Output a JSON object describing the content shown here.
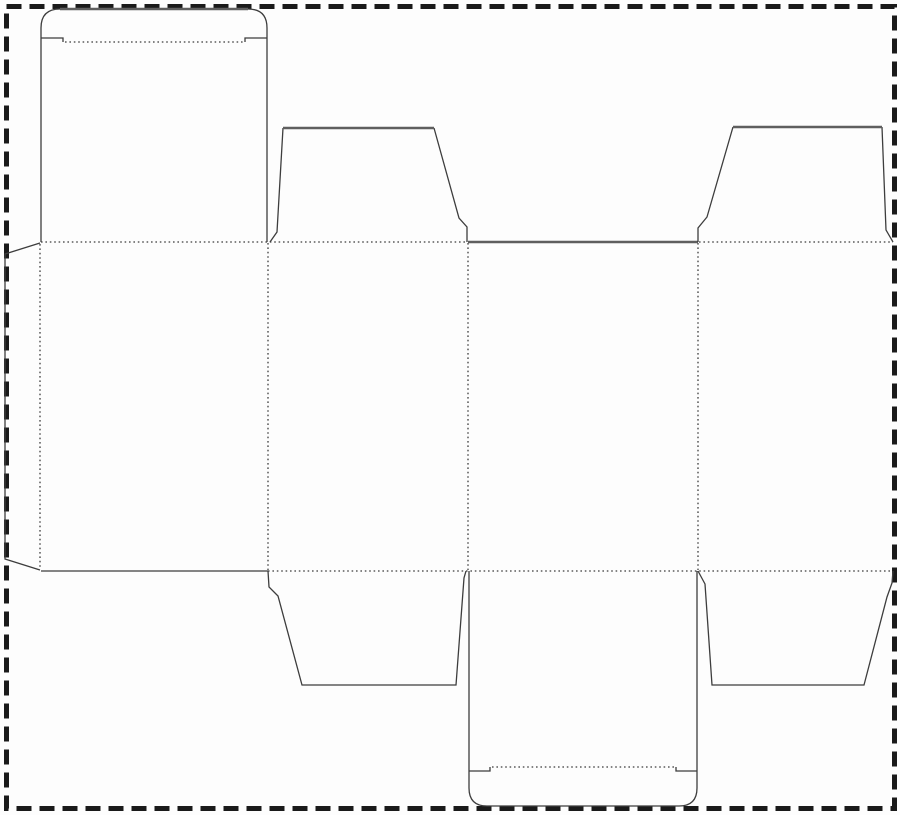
{
  "canvas": {
    "width": 900,
    "height": 815,
    "background": "#fdfdfd"
  },
  "border": {
    "x": 6.5,
    "y": 6.5,
    "width": 888,
    "height": 802,
    "stroke": "#1a1a1a",
    "stroke_width": 5,
    "dash": "15 8"
  },
  "styles": {
    "cut": {
      "stroke": "#3d3d3d",
      "width": 1.3
    },
    "heavy": {
      "stroke": "#5f5f5f",
      "width": 2.4
    },
    "fold": {
      "stroke": "#3d3d3d",
      "width": 1.3,
      "dash": "1.6 2.8"
    }
  },
  "shapes": [
    {
      "name": "top-lid-left-edge",
      "style": "cut",
      "d": "M41,242 L41,28 Q41,9 60,9"
    },
    {
      "name": "top-lid-top-edge",
      "style": "heavy",
      "d": "M60,9 L248,9"
    },
    {
      "name": "top-lid-right-edge",
      "style": "cut",
      "d": "M248,9 Q267,9 267,28 L267,242"
    },
    {
      "name": "top-lid-tuck-notch-left",
      "style": "cut",
      "d": "M41,38 L63,38 L63,42"
    },
    {
      "name": "top-lid-tuck-notch-right",
      "style": "cut",
      "d": "M267,38 L245,38 L245,42"
    },
    {
      "name": "top-lid-tuck-fold",
      "style": "fold",
      "d": "M65,42 L243,42"
    },
    {
      "name": "glue-flap-outline",
      "style": "cut",
      "d": "M40,243 L5,254 L5,559 L40,570"
    },
    {
      "name": "glue-flap-fold",
      "style": "fold",
      "d": "M40,244 L40,569"
    },
    {
      "name": "top-fold-left-section",
      "style": "fold",
      "d": "M41,242 L467,242"
    },
    {
      "name": "top-edge-center-cut",
      "style": "heavy",
      "d": "M468,242 L698,242"
    },
    {
      "name": "top-fold-right-section",
      "style": "fold",
      "d": "M699,242 L893,242"
    },
    {
      "name": "bottom-edge-left-cut",
      "style": "cut",
      "d": "M41,571 L268,571"
    },
    {
      "name": "bottom-fold-section",
      "style": "fold",
      "d": "M268,571 L893,571"
    },
    {
      "name": "panel-fold-1",
      "style": "fold",
      "d": "M268,243 L268,570"
    },
    {
      "name": "panel-fold-2",
      "style": "fold",
      "d": "M468,243 L468,570"
    },
    {
      "name": "panel-fold-3",
      "style": "fold",
      "d": "M698,243 L698,570"
    },
    {
      "name": "top-dust-flap-left-sides",
      "style": "cut",
      "d": "M270,242 L277,232 L283,128 M434,128 L459,218 L467,227 L467,242"
    },
    {
      "name": "top-dust-flap-left-top",
      "style": "heavy",
      "d": "M283,128 L434,128"
    },
    {
      "name": "top-dust-flap-right-sides",
      "style": "cut",
      "d": "M698,242 L698,228 L707,217 L733,127 M882,127 L886,230 L893,242"
    },
    {
      "name": "top-dust-flap-right-top",
      "style": "heavy",
      "d": "M733,127 L882,127"
    },
    {
      "name": "bottom-dust-flap-left",
      "style": "cut",
      "d": "M268,571 L269,587 L278,596 L302,685 L456,685 L464,578 L466,571"
    },
    {
      "name": "bottom-dust-flap-right",
      "style": "cut",
      "d": "M698,571 L705,584 L712,685 L864,685 L887,597 L892,583 L893,571"
    },
    {
      "name": "bottom-lid-outline",
      "style": "cut",
      "d": "M469,571 L469,788 Q469,806 487,806 L679,806 Q697,806 697,788 L697,571"
    },
    {
      "name": "bottom-lid-tuck-notch-left",
      "style": "cut",
      "d": "M469,771 L490,771 L490,767"
    },
    {
      "name": "bottom-lid-tuck-notch-right",
      "style": "cut",
      "d": "M697,771 L676,771 L676,767"
    },
    {
      "name": "bottom-lid-tuck-fold",
      "style": "fold",
      "d": "M492,767 L674,767"
    }
  ]
}
